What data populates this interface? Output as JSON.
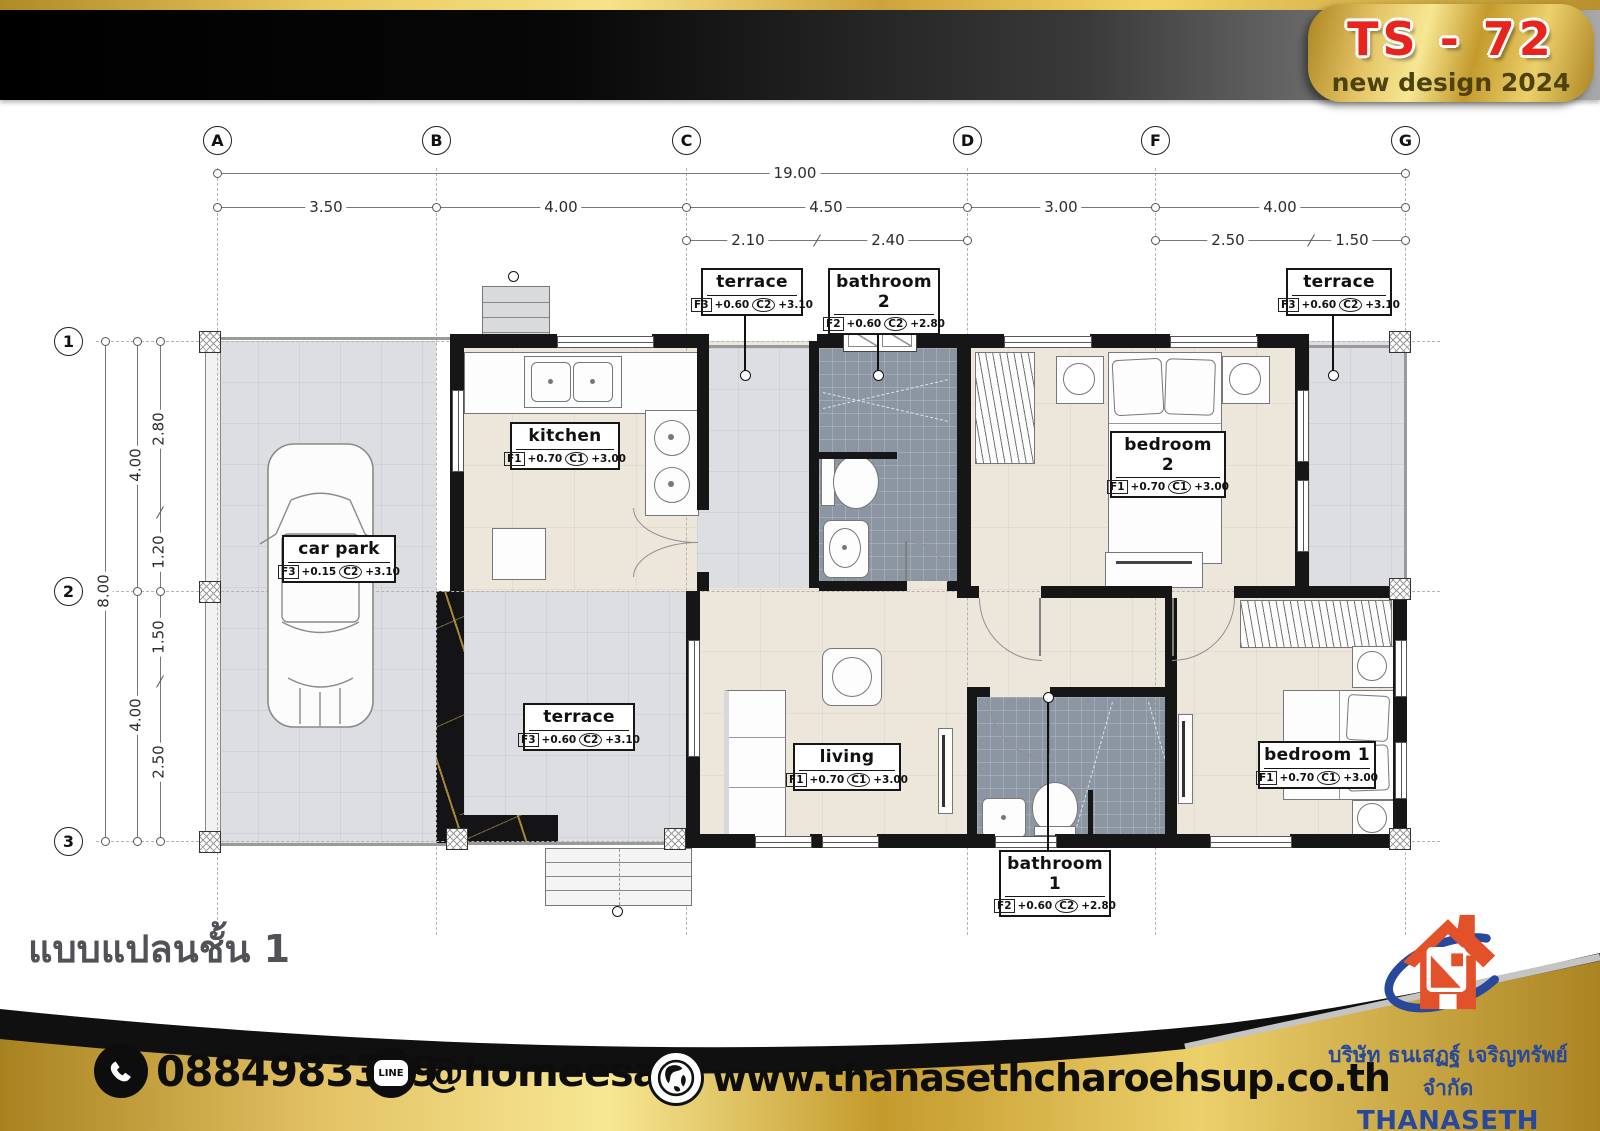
{
  "header": {
    "badge_code": "TS - 72",
    "badge_subtitle": "new design 2024"
  },
  "plan": {
    "title": "แบบแปลนชั้น 1",
    "grid_cols": [
      "A",
      "B",
      "C",
      "D",
      "F",
      "G"
    ],
    "grid_rows": [
      "1",
      "2",
      "3"
    ],
    "dims": {
      "total": "19.00",
      "seg": [
        "3.50",
        "4.00",
        "4.50",
        "3.00",
        "4.00"
      ],
      "sub": [
        "2.10",
        "2.40",
        "2.50",
        "1.50"
      ],
      "vtotal": "8.00",
      "vseg": [
        "4.00",
        "4.00"
      ],
      "vsub": [
        "2.80",
        "1.20",
        "1.50",
        "2.50"
      ]
    },
    "rooms": [
      {
        "name": "kitchen",
        "f": "F1",
        "fv": "+0.70",
        "c": "C1",
        "cv": "+3.00"
      },
      {
        "name": "car park",
        "f": "F3",
        "fv": "+0.15",
        "c": "C2",
        "cv": "+3.10"
      },
      {
        "name": "terrace",
        "f": "F3",
        "fv": "+0.60",
        "c": "C2",
        "cv": "+3.10"
      },
      {
        "name": "bathroom 2",
        "f": "F2",
        "fv": "+0.60",
        "c": "C2",
        "cv": "+2.80"
      },
      {
        "name": "terrace",
        "f": "F3",
        "fv": "+0.60",
        "c": "C2",
        "cv": "+3.10"
      },
      {
        "name": "bedroom 2",
        "f": "F1",
        "fv": "+0.70",
        "c": "C1",
        "cv": "+3.00"
      },
      {
        "name": "terrace",
        "f": "F3",
        "fv": "+0.60",
        "c": "C2",
        "cv": "+3.10"
      },
      {
        "name": "living",
        "f": "F1",
        "fv": "+0.70",
        "c": "C1",
        "cv": "+3.00"
      },
      {
        "name": "bathroom 1",
        "f": "F2",
        "fv": "+0.60",
        "c": "C2",
        "cv": "+2.80"
      },
      {
        "name": "bedroom 1",
        "f": "F1",
        "fv": "+0.70",
        "c": "C1",
        "cv": "+3.00"
      }
    ]
  },
  "footer": {
    "phone": "0884983399",
    "line_badge": "LINE",
    "line_id": "@homeesan",
    "website": "www.thanasethcharoehsup.co.th"
  },
  "company": {
    "name_th": "บริษัท ธนเสฏฐ์ เจริญทรัพย์ จำกัด",
    "name_en": "THANASETH CHAROENSUP",
    "suffix": "CO., LTD."
  },
  "colors": {
    "gold": "#d4af37",
    "red": "#e8251c",
    "blue": "#27489b",
    "orange": "#e2512a",
    "beige": "#ece6db",
    "tile_gray": "#dcdee1",
    "slate": "#8c96a3",
    "wall": "#161616"
  }
}
